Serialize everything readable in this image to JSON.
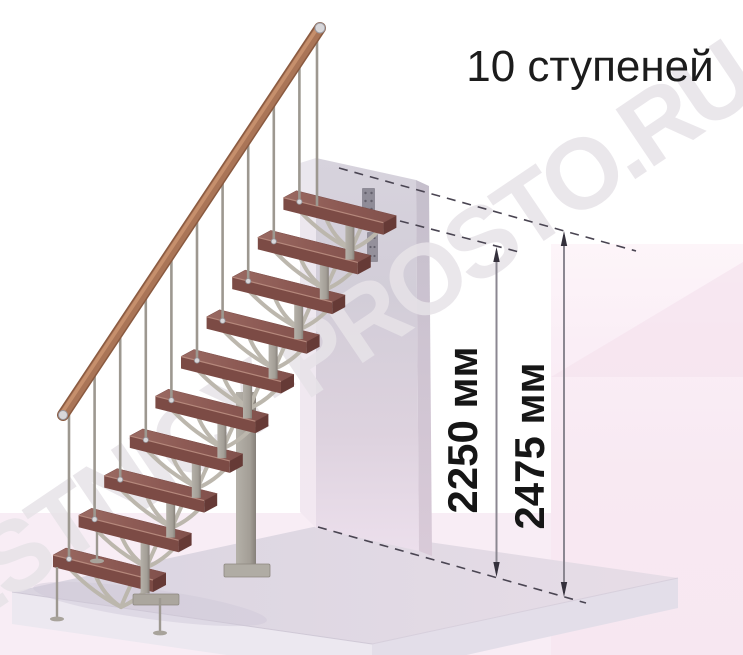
{
  "title": {
    "text": "10 ступеней"
  },
  "watermark": {
    "text": "LESTNICY-PROSTO.RU"
  },
  "dimensions": [
    {
      "label": "2250 мм",
      "value": 2250,
      "unit": "мм",
      "description": "height to top step"
    },
    {
      "label": "2475 мм",
      "value": 2475,
      "unit": "мм",
      "description": "height to landing level"
    }
  ],
  "stairs": {
    "step_count": 10,
    "type": "modular staircase on central spine with handrail"
  },
  "colors": {
    "step_wood_top": "#8f5c56",
    "step_wood_front": "#7c4b45",
    "step_wood_side": "#663a36",
    "handrail_wood": "#aa7557",
    "metal_frame": "#a39e96",
    "branch_metal": "#bcb7ad",
    "wall_gray": "#d5d1db",
    "floor_lavender": "#dcd7e2",
    "background_pink": "#fbf0f7",
    "floor_pink": "#f8edf5",
    "dimension_line": "#35313c",
    "dash_line": "#4a4552",
    "text": "#1c1c1c"
  }
}
